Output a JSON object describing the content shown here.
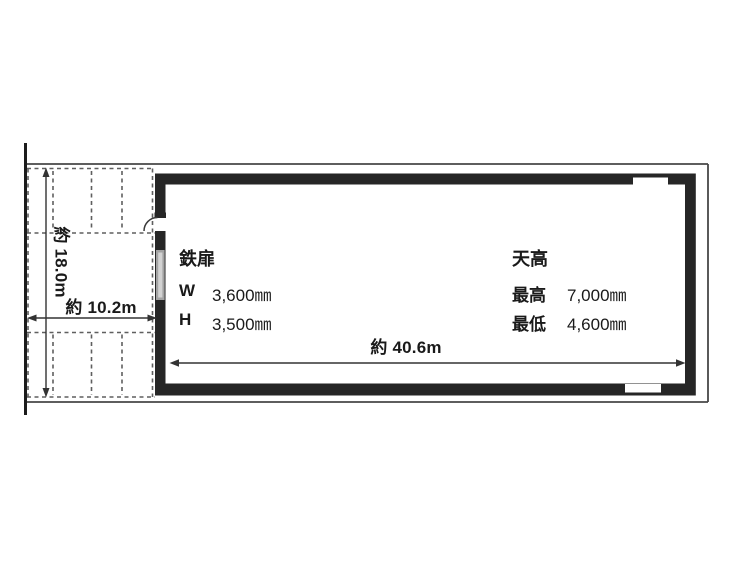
{
  "colors": {
    "wall": "#262626",
    "boundary_line": "#474747",
    "dash_line": "#5f5f5f",
    "dimension_line": "#333333",
    "door_gray": "#a3a3a3",
    "door_gray_light": "#d2d2d2",
    "text": "#1a1a1a",
    "background": "#ffffff"
  },
  "labels": {
    "steel_door": {
      "title": "鉄扉",
      "rows": [
        {
          "label": "W",
          "value": "3,600㎜"
        },
        {
          "label": "H",
          "value": "3,500㎜"
        }
      ]
    },
    "ceiling_height": {
      "title": "天高",
      "rows": [
        {
          "label": "最高",
          "value": "7,000㎜"
        },
        {
          "label": "最低",
          "value": "4,600㎜"
        }
      ]
    },
    "dimensions": {
      "width": "約 40.6m",
      "depth": "約 18.0m",
      "frontage": "約 10.2m"
    }
  }
}
